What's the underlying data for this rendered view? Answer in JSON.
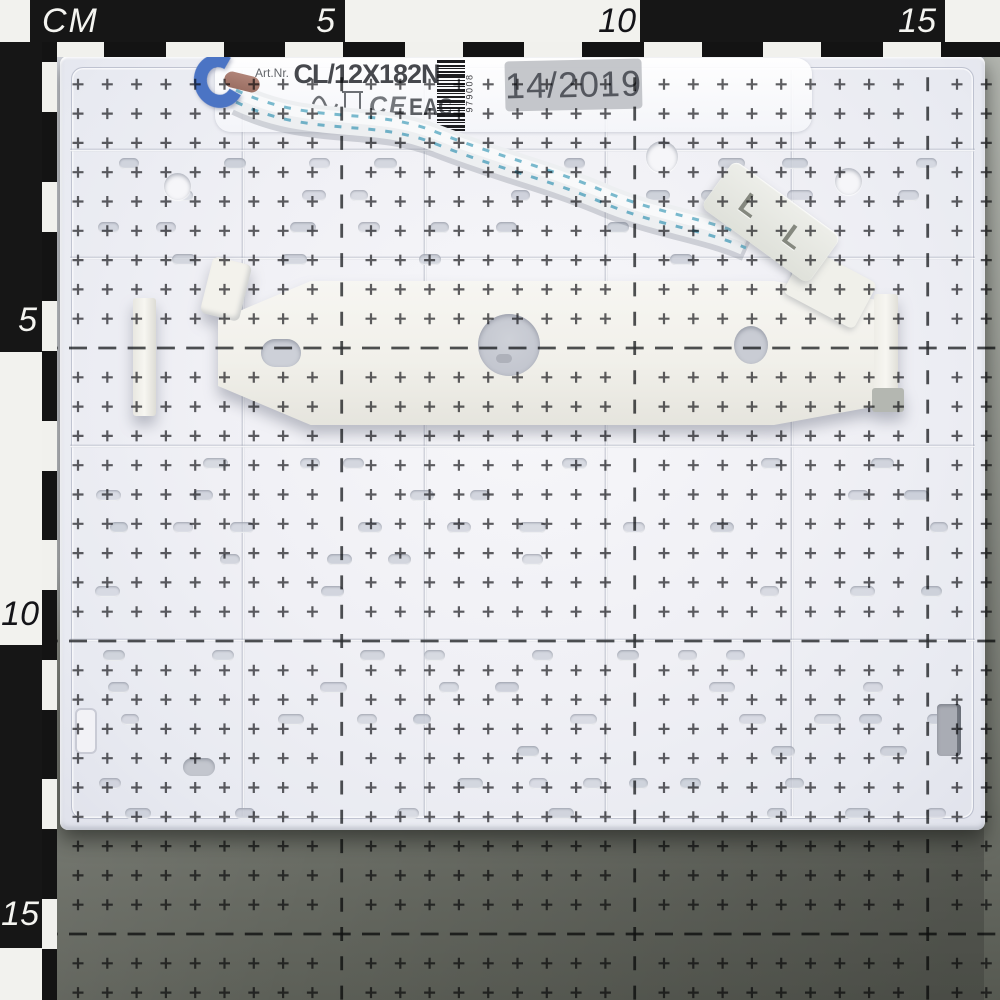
{
  "ruler": {
    "unit_label": "CM",
    "top_marks": [
      "5",
      "10",
      "15"
    ],
    "left_marks": [
      "5",
      "10",
      "15"
    ]
  },
  "label": {
    "art_prefix": "Art.Nr.",
    "art_number": "CL/12X182N",
    "date_stamp": "14/2019",
    "barcode_digits": "979008",
    "cert_ce": "CE",
    "cert_eac": "EAC"
  },
  "connector": {
    "marking": "L L"
  },
  "colors": {
    "panel_white": "#f0f0f5",
    "board_light_gray": "#cdd0d8",
    "board_dark_gray": "#62655e",
    "bracket_white": "#f1f0ea",
    "wire_clip_blue": "#4b74c4",
    "cable_stitch_blue": "#76b7cc",
    "grid_ink": "#222428",
    "ruler_black": "#161616",
    "ruler_white": "#f2f2ee",
    "stamp_gray": "#b8bbbf"
  }
}
